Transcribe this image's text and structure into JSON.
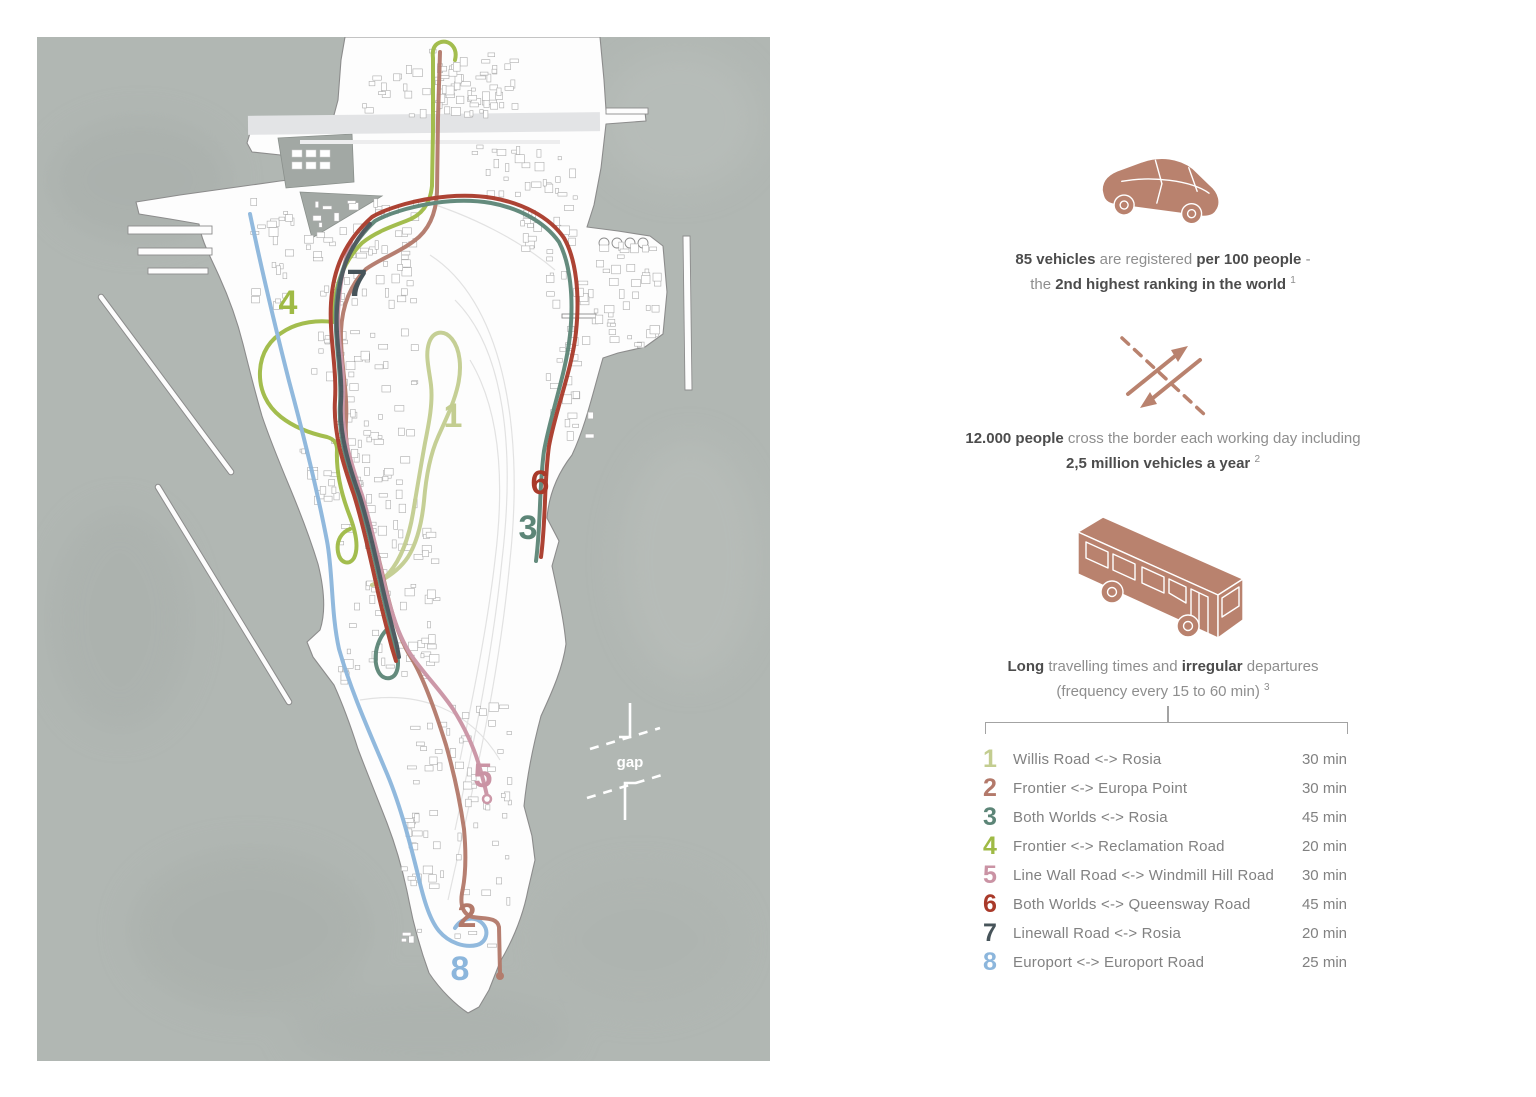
{
  "theme": {
    "accent": "#b9826e",
    "sea": "#b1b7b3",
    "sea_dark": "#a2a8a4",
    "land": "#fdfdfd",
    "line": "#a3a3a3",
    "text_dark": "#4c4c4c",
    "text_light": "#8e8e8e",
    "gap_white": "#ffffff"
  },
  "map": {
    "gap_label": "gap"
  },
  "stats": {
    "car": {
      "icon": "car-icon",
      "b1": "85 vehicles",
      "r1": " are registered ",
      "b2": "per 100 people",
      "r2": " -",
      "r3": "the ",
      "b3": "2nd highest ranking in the world",
      "sup": "1"
    },
    "border": {
      "icon": "border-crossing-icon",
      "b1": "12.000 people",
      "r1": " cross the border each working day including",
      "b2": "2,5 million vehicles a year",
      "sup": "2"
    },
    "bus": {
      "icon": "bus-icon",
      "b1": "Long",
      "r1": " travelling times and ",
      "b2": "irregular",
      "r2": " departures",
      "r3": "(frequency every 15 to 60 min)",
      "sup": "3"
    }
  },
  "routes": [
    {
      "num": "1",
      "color": "#c3cd90",
      "name": "Willis Road <-> Rosia",
      "duration": "30 min"
    },
    {
      "num": "2",
      "color": "#b3796a",
      "name": "Frontier <-> Europa Point",
      "duration": "30 min"
    },
    {
      "num": "3",
      "color": "#5c8577",
      "name": "Both Worlds <-> Rosia",
      "duration": "45 min"
    },
    {
      "num": "4",
      "color": "#9fba45",
      "name": "Frontier <-> Reclamation Road",
      "duration": "20 min"
    },
    {
      "num": "5",
      "color": "#ca93a4",
      "name": "Line Wall Road <-> Windmill Hill Road",
      "duration": "30 min"
    },
    {
      "num": "6",
      "color": "#a93a2a",
      "name": "Both Worlds <-> Queensway Road",
      "duration": "45 min"
    },
    {
      "num": "7",
      "color": "#47545a",
      "name": "Linewall Road <-> Rosia",
      "duration": "20 min"
    },
    {
      "num": "8",
      "color": "#8cb6dc",
      "name": "Europort <-> Europort Road",
      "duration": "25 min"
    }
  ]
}
